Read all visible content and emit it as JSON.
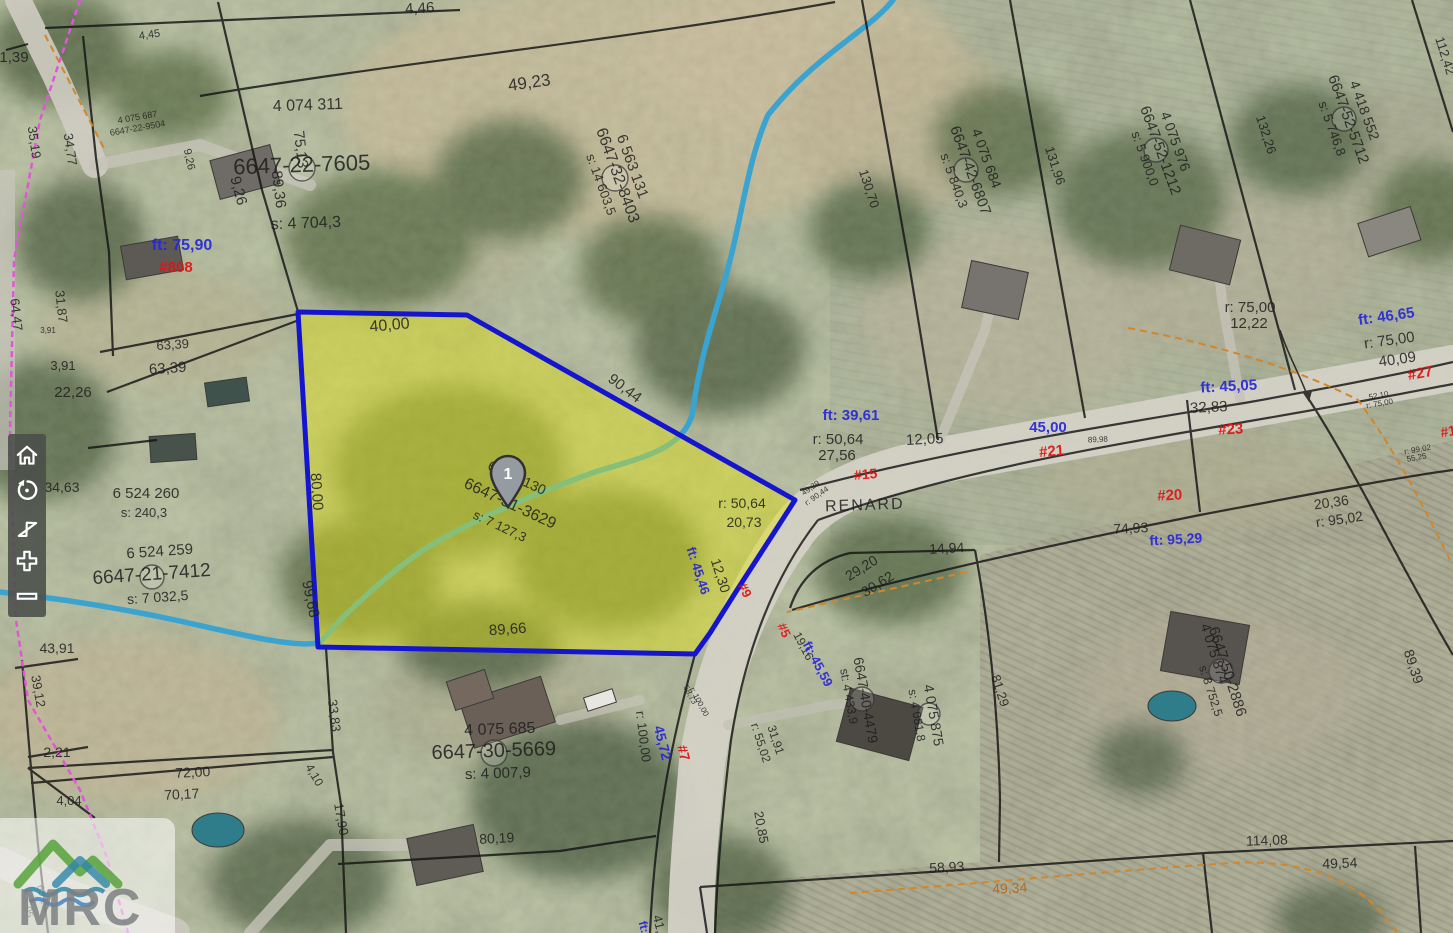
{
  "map": {
    "road_name": "RENARD",
    "marker": {
      "label": "1"
    },
    "label_colors": {
      "black": "#1d1d1d",
      "blue": "#2626d8",
      "red": "#dd1414",
      "orange": "#b5651d"
    },
    "labels": [
      {
        "t": "1,39",
        "x": 14,
        "y": 62,
        "s": 15
      },
      {
        "t": "4,45",
        "x": 150,
        "y": 38,
        "r": -8,
        "s": 11
      },
      {
        "t": "4,46",
        "x": 420,
        "y": 13,
        "r": -3,
        "s": 15
      },
      {
        "t": "49,23",
        "x": 530,
        "y": 88,
        "r": -8,
        "s": 17
      },
      {
        "t": "9,26",
        "x": 186,
        "y": 160,
        "r": 78,
        "s": 11
      },
      {
        "t": "9,26",
        "x": 234,
        "y": 192,
        "r": 75,
        "s": 15
      },
      {
        "t": "35,19",
        "x": 30,
        "y": 143,
        "r": 82,
        "s": 13
      },
      {
        "t": "34,77",
        "x": 66,
        "y": 150,
        "r": 82,
        "s": 13
      },
      {
        "t": "4 075 687",
        "x": 138,
        "y": 120,
        "r": -10,
        "s": 9
      },
      {
        "t": "6647-22-9504",
        "x": 138,
        "y": 131,
        "r": -10,
        "s": 9
      },
      {
        "t": "4 074 311",
        "x": 308,
        "y": 110,
        "r": -2,
        "s": 16
      },
      {
        "t": "6647-22-7605",
        "x": 302,
        "y": 172,
        "r": -2,
        "s": 22
      },
      {
        "t": "s: 4 704,3",
        "x": 306,
        "y": 228,
        "r": -2,
        "s": 16
      },
      {
        "t": "75,13",
        "x": 296,
        "y": 150,
        "r": 83,
        "s": 15
      },
      {
        "t": "89,36",
        "x": 274,
        "y": 190,
        "r": 83,
        "s": 15
      },
      {
        "t": "ft: 75,90",
        "x": 182,
        "y": 250,
        "c": "blue",
        "s": 16
      },
      {
        "t": "#808",
        "x": 176,
        "y": 272,
        "c": "red",
        "s": 15
      },
      {
        "t": "31,87",
        "x": 57,
        "y": 307,
        "r": 84,
        "s": 13
      },
      {
        "t": "64,47",
        "x": 12,
        "y": 315,
        "r": 84,
        "s": 13
      },
      {
        "t": "3,91",
        "x": 48,
        "y": 333,
        "s": 8
      },
      {
        "t": "3,91",
        "x": 63,
        "y": 370,
        "s": 13
      },
      {
        "t": "63,39",
        "x": 173,
        "y": 349,
        "r": -4,
        "s": 13
      },
      {
        "t": "63,39",
        "x": 168,
        "y": 373,
        "r": -4,
        "s": 15
      },
      {
        "t": "22,26",
        "x": 73,
        "y": 397,
        "s": 15
      },
      {
        "t": "34,63",
        "x": 62,
        "y": 492,
        "s": 14
      },
      {
        "t": "6 524 260",
        "x": 146,
        "y": 498,
        "s": 15
      },
      {
        "t": "s: 240,3",
        "x": 144,
        "y": 517,
        "s": 13
      },
      {
        "t": "6 524 259",
        "x": 160,
        "y": 556,
        "r": -4,
        "s": 15
      },
      {
        "t": "6647-21-7412",
        "x": 152,
        "y": 580,
        "r": -4,
        "s": 19
      },
      {
        "t": "s: 7 032,5",
        "x": 158,
        "y": 602,
        "r": -4,
        "s": 14
      },
      {
        "t": "43,91",
        "x": 57,
        "y": 653,
        "s": 14
      },
      {
        "t": "39,12",
        "x": 34,
        "y": 692,
        "r": 80,
        "s": 13
      },
      {
        "t": "2,21",
        "x": 57,
        "y": 757,
        "s": 14
      },
      {
        "t": "4,04",
        "x": 69,
        "y": 805,
        "s": 13
      },
      {
        "t": "72,00",
        "x": 193,
        "y": 777,
        "r": -3,
        "s": 14
      },
      {
        "t": "70,17",
        "x": 182,
        "y": 799,
        "r": -3,
        "s": 14
      },
      {
        "t": "65,05",
        "x": 24,
        "y": 906,
        "r": 75,
        "s": 10
      },
      {
        "t": "65,20",
        "x": 40,
        "y": 898,
        "r": 75,
        "s": 10
      },
      {
        "t": "33,83",
        "x": 330,
        "y": 716,
        "r": 83,
        "s": 13
      },
      {
        "t": "4,10",
        "x": 311,
        "y": 777,
        "r": 60,
        "s": 12
      },
      {
        "t": "17,90",
        "x": 337,
        "y": 820,
        "r": 80,
        "s": 13
      },
      {
        "t": "6 563 131",
        "x": 628,
        "y": 168,
        "r": 70,
        "s": 15
      },
      {
        "t": "6647-32-8403",
        "x": 613,
        "y": 177,
        "r": 70,
        "s": 16
      },
      {
        "t": "s: 14 603,5",
        "x": 597,
        "y": 186,
        "r": 70,
        "s": 13
      },
      {
        "t": "40,00",
        "x": 390,
        "y": 330,
        "r": -5,
        "s": 16
      },
      {
        "t": "90,44",
        "x": 622,
        "y": 392,
        "r": 37,
        "s": 15
      },
      {
        "t": "80,00",
        "x": 312,
        "y": 492,
        "r": 86,
        "s": 15
      },
      {
        "t": "99,68",
        "x": 306,
        "y": 600,
        "r": 78,
        "s": 15
      },
      {
        "t": "89,66",
        "x": 508,
        "y": 634,
        "r": -4,
        "s": 15
      },
      {
        "t": "6 524 130",
        "x": 515,
        "y": 482,
        "r": 25,
        "s": 14
      },
      {
        "t": "6647-31-3629",
        "x": 508,
        "y": 508,
        "r": 25,
        "s": 16
      },
      {
        "t": "s: 7 127,3",
        "x": 498,
        "y": 530,
        "r": 25,
        "s": 13
      },
      {
        "t": "r: 50,64",
        "x": 742,
        "y": 508,
        "s": 14
      },
      {
        "t": "20,73",
        "x": 744,
        "y": 527,
        "s": 14
      },
      {
        "t": "ft: 45,46",
        "x": 694,
        "y": 572,
        "r": 72,
        "c": "blue",
        "s": 13
      },
      {
        "t": "12,30",
        "x": 716,
        "y": 577,
        "r": 72,
        "s": 14
      },
      {
        "t": "ft: 39,61",
        "x": 851,
        "y": 420,
        "c": "blue",
        "s": 15
      },
      {
        "t": "r: 50,64",
        "x": 838,
        "y": 444,
        "s": 15
      },
      {
        "t": "27,56",
        "x": 837,
        "y": 460,
        "s": 15
      },
      {
        "t": "12,05",
        "x": 925,
        "y": 444,
        "r": -3,
        "s": 15
      },
      {
        "t": "45,00",
        "x": 1048,
        "y": 432,
        "c": "blue",
        "s": 15
      },
      {
        "t": "#21",
        "x": 1052,
        "y": 456,
        "r": -5,
        "c": "red",
        "s": 15
      },
      {
        "t": "#15",
        "x": 866,
        "y": 479,
        "r": -5,
        "c": "red",
        "s": 14
      },
      {
        "t": "RENARD",
        "x": 865,
        "y": 510,
        "r": -2,
        "s": 16,
        "ls": 2
      },
      {
        "t": "89,98",
        "x": 1098,
        "y": 442,
        "r": -3,
        "s": 8
      },
      {
        "t": "49,29",
        "x": 812,
        "y": 490,
        "r": -35,
        "s": 8
      },
      {
        "t": "r: 90,44",
        "x": 818,
        "y": 498,
        "r": -35,
        "s": 8
      },
      {
        "t": "#9",
        "x": 741,
        "y": 592,
        "r": 65,
        "c": "red",
        "s": 13
      },
      {
        "t": "#5",
        "x": 780,
        "y": 632,
        "r": 65,
        "c": "red",
        "s": 13
      },
      {
        "t": "14,94",
        "x": 947,
        "y": 553,
        "r": -3,
        "s": 14
      },
      {
        "t": "29,20",
        "x": 864,
        "y": 572,
        "r": -32,
        "s": 14
      },
      {
        "t": "30,62",
        "x": 880,
        "y": 588,
        "r": -32,
        "s": 14
      },
      {
        "t": "19,16",
        "x": 800,
        "y": 648,
        "r": 62,
        "s": 12
      },
      {
        "t": "ft: 45,59",
        "x": 814,
        "y": 666,
        "r": 62,
        "c": "blue",
        "s": 13
      },
      {
        "t": "6647-40-4479",
        "x": 861,
        "y": 701,
        "r": 80,
        "s": 14
      },
      {
        "t": "st: 4 433,9",
        "x": 845,
        "y": 697,
        "r": 80,
        "s": 12
      },
      {
        "t": "4 075 875",
        "x": 929,
        "y": 716,
        "r": 80,
        "s": 14
      },
      {
        "t": "s: 4 081,8",
        "x": 913,
        "y": 716,
        "r": 80,
        "s": 12
      },
      {
        "t": "31,91",
        "x": 772,
        "y": 741,
        "r": 72,
        "s": 12
      },
      {
        "t": "r: 55,02",
        "x": 757,
        "y": 744,
        "r": 72,
        "s": 12
      },
      {
        "t": "81,29",
        "x": 996,
        "y": 692,
        "r": 72,
        "s": 13
      },
      {
        "t": "20,85",
        "x": 757,
        "y": 828,
        "r": 80,
        "s": 13
      },
      {
        "t": "r: 100,00",
        "x": 639,
        "y": 737,
        "r": 83,
        "s": 13
      },
      {
        "t": "45,72",
        "x": 658,
        "y": 744,
        "r": 76,
        "c": "blue",
        "s": 14
      },
      {
        "t": "#7",
        "x": 679,
        "y": 754,
        "r": 76,
        "c": "red",
        "s": 14
      },
      {
        "t": "58,73",
        "x": 688,
        "y": 696,
        "r": 62,
        "s": 8
      },
      {
        "t": "r: 100,00",
        "x": 697,
        "y": 703,
        "r": 62,
        "s": 8
      },
      {
        "t": "4 075 685",
        "x": 500,
        "y": 734,
        "r": -2,
        "s": 16
      },
      {
        "t": "6647-30-5669",
        "x": 494,
        "y": 757,
        "r": -2,
        "s": 20
      },
      {
        "t": "s: 4 007,9",
        "x": 498,
        "y": 778,
        "r": -2,
        "s": 15
      },
      {
        "t": "80,19",
        "x": 497,
        "y": 843,
        "r": -3,
        "s": 14
      },
      {
        "t": "41,",
        "x": 655,
        "y": 925,
        "r": 76,
        "s": 13
      },
      {
        "t": "ft:",
        "x": 640,
        "y": 928,
        "r": 76,
        "c": "blue",
        "s": 12
      },
      {
        "t": "58,93",
        "x": 947,
        "y": 872,
        "r": -3,
        "s": 14
      },
      {
        "t": "49,34",
        "x": 1010,
        "y": 893,
        "r": -3,
        "s": 14,
        "c": "orange"
      },
      {
        "t": "114,08",
        "x": 1267,
        "y": 845,
        "r": -2,
        "s": 14
      },
      {
        "t": "49,54",
        "x": 1340,
        "y": 868,
        "r": -2,
        "s": 14
      },
      {
        "t": "4 075 874",
        "x": 1210,
        "y": 655,
        "r": 72,
        "s": 14
      },
      {
        "t": "6647-50-2886",
        "x": 1223,
        "y": 673,
        "r": 72,
        "s": 15
      },
      {
        "t": "s: 8 752,5",
        "x": 1207,
        "y": 692,
        "r": 72,
        "s": 12
      },
      {
        "t": "89,39",
        "x": 1409,
        "y": 668,
        "r": 72,
        "s": 14
      },
      {
        "t": "74,93",
        "x": 1131,
        "y": 533,
        "r": -3,
        "s": 14
      },
      {
        "t": "ft: 95,29",
        "x": 1176,
        "y": 544,
        "r": -3,
        "c": "blue",
        "s": 14
      },
      {
        "t": "#20",
        "x": 1170,
        "y": 500,
        "r": -3,
        "c": "red",
        "s": 15
      },
      {
        "t": "20,36",
        "x": 1332,
        "y": 507,
        "r": -8,
        "s": 14
      },
      {
        "t": "r: 95,02",
        "x": 1340,
        "y": 524,
        "r": -8,
        "s": 14
      },
      {
        "t": "#23",
        "x": 1231,
        "y": 434,
        "r": -3,
        "c": "red",
        "s": 15
      },
      {
        "t": "32,83",
        "x": 1209,
        "y": 412,
        "r": -3,
        "s": 15
      },
      {
        "t": "ft: 45,05",
        "x": 1229,
        "y": 391,
        "r": -3,
        "c": "blue",
        "s": 15
      },
      {
        "t": "r: 75,00",
        "x": 1250,
        "y": 312,
        "s": 15
      },
      {
        "t": "12,22",
        "x": 1249,
        "y": 328,
        "s": 15
      },
      {
        "t": "ft: 46,65",
        "x": 1387,
        "y": 321,
        "r": -8,
        "c": "blue",
        "s": 15
      },
      {
        "t": "r: 75,00",
        "x": 1390,
        "y": 345,
        "r": -8,
        "s": 15
      },
      {
        "t": "40,09",
        "x": 1398,
        "y": 364,
        "r": -8,
        "s": 15
      },
      {
        "t": "#27",
        "x": 1421,
        "y": 378,
        "r": -10,
        "c": "red",
        "s": 15
      },
      {
        "t": "52,10",
        "x": 1379,
        "y": 398,
        "r": -10,
        "s": 8
      },
      {
        "t": "r: 75,00",
        "x": 1380,
        "y": 406,
        "r": -10,
        "s": 8
      },
      {
        "t": "r: 99,02",
        "x": 1418,
        "y": 452,
        "r": -10,
        "s": 8
      },
      {
        "t": "55,25",
        "x": 1417,
        "y": 460,
        "r": -10,
        "s": 8
      },
      {
        "t": "#1",
        "x": 1449,
        "y": 436,
        "r": -10,
        "c": "red",
        "s": 14
      },
      {
        "t": "4 075 684",
        "x": 982,
        "y": 160,
        "r": 70,
        "s": 14
      },
      {
        "t": "6647-42-6807",
        "x": 966,
        "y": 172,
        "r": 70,
        "s": 15
      },
      {
        "t": "s: 5 840,3",
        "x": 950,
        "y": 182,
        "r": 70,
        "s": 13
      },
      {
        "t": "130,70",
        "x": 865,
        "y": 190,
        "r": 72,
        "s": 13
      },
      {
        "t": "131,96",
        "x": 1051,
        "y": 167,
        "r": 72,
        "s": 13
      },
      {
        "t": "4 075 976",
        "x": 1171,
        "y": 143,
        "r": 70,
        "s": 14
      },
      {
        "t": "6647-52-1212",
        "x": 1156,
        "y": 152,
        "r": 70,
        "s": 15
      },
      {
        "t": "s: 5 900,0",
        "x": 1141,
        "y": 160,
        "r": 70,
        "s": 13
      },
      {
        "t": "132,26",
        "x": 1262,
        "y": 136,
        "r": 72,
        "s": 13
      },
      {
        "t": "4 418 552",
        "x": 1360,
        "y": 112,
        "r": 70,
        "s": 14
      },
      {
        "t": "6647-52-5712",
        "x": 1344,
        "y": 121,
        "r": 70,
        "s": 15
      },
      {
        "t": "s: 5 746,8",
        "x": 1328,
        "y": 130,
        "r": 70,
        "s": 13
      },
      {
        "t": "112,42",
        "x": 1441,
        "y": 57,
        "r": 72,
        "s": 13
      }
    ]
  },
  "toolbar": {
    "buttons": [
      {
        "id": "home",
        "label": "Home"
      },
      {
        "id": "rotate",
        "label": "Reset rotation"
      },
      {
        "id": "locate",
        "label": "My location"
      },
      {
        "id": "zoom-in",
        "label": "Zoom in"
      },
      {
        "id": "zoom-out",
        "label": "Zoom out"
      }
    ]
  },
  "logo": {
    "text": "MRC"
  }
}
